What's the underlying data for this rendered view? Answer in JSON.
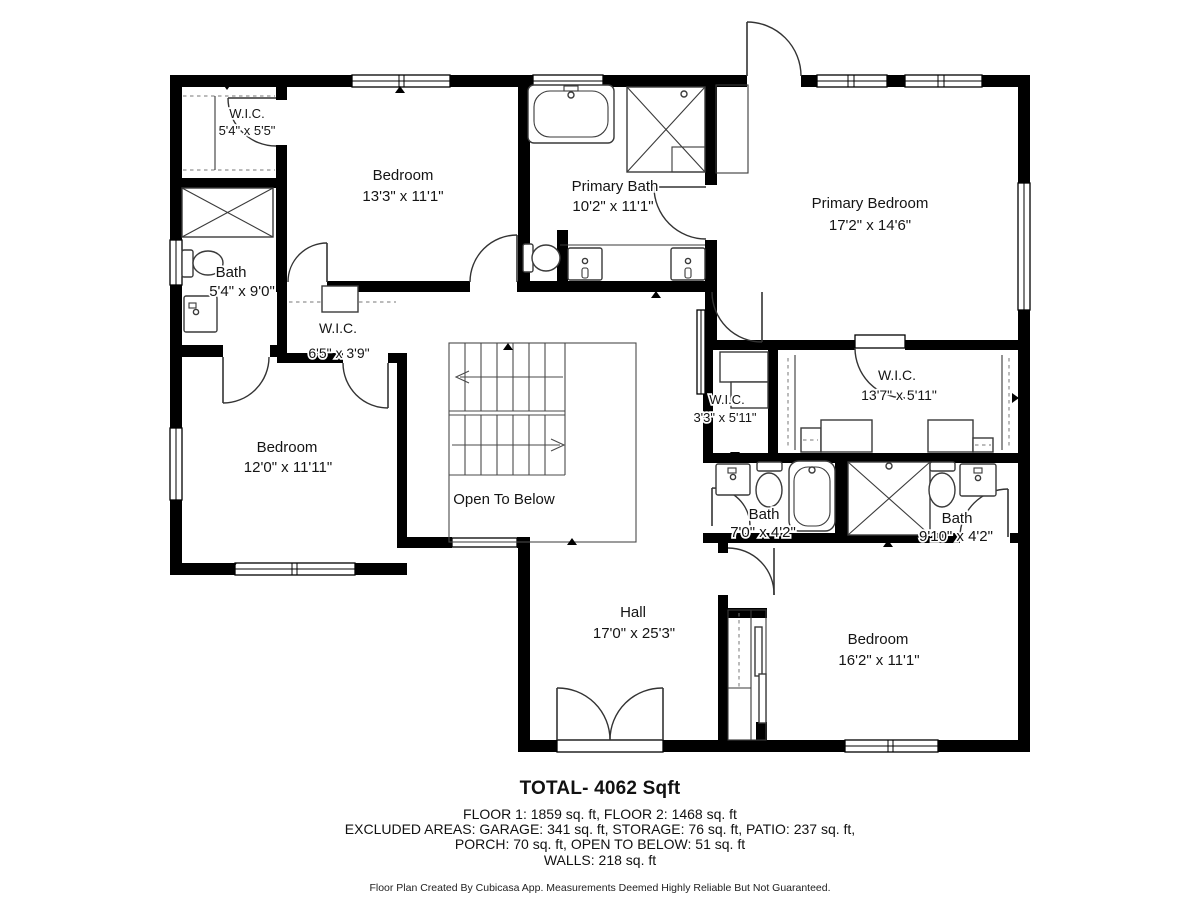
{
  "rooms": {
    "wic_top_left": {
      "name": "W.I.C.",
      "dims": "5'4\" x 5'5\""
    },
    "bedroom_top": {
      "name": "Bedroom",
      "dims": "13'3\" x 11'1\""
    },
    "primary_bath": {
      "name": "Primary Bath",
      "dims": "10'2\" x 11'1\""
    },
    "primary_bedroom": {
      "name": "Primary Bedroom",
      "dims": "17'2\" x 14'6\""
    },
    "bath_left": {
      "name": "Bath",
      "dims": "5'4\" x 9'0\""
    },
    "wic_shared": {
      "name": "W.I.C.",
      "dims": "6'5\" x 3'9\""
    },
    "bedroom_left": {
      "name": "Bedroom",
      "dims": "12'0\" x 11'11\""
    },
    "open_to_below": {
      "name": "Open To Below"
    },
    "wic_small": {
      "name": "W.I.C.",
      "dims": "3'3\" x 5'11\""
    },
    "wic_primary": {
      "name": "W.I.C.",
      "dims": "13'7\" x 5'11\""
    },
    "bath_middle": {
      "name": "Bath",
      "dims": "7'0\" x 4'2\""
    },
    "bath_right": {
      "name": "Bath",
      "dims": "9'10\" x 4'2\""
    },
    "hall": {
      "name": "Hall",
      "dims": "17'0\" x 25'3\""
    },
    "bedroom_bottom": {
      "name": "Bedroom",
      "dims": "16'2\" x 11'1\""
    }
  },
  "summary": {
    "total": "TOTAL- 4062 Sqft",
    "line1": "FLOOR 1: 1859 sq. ft, FLOOR 2: 1468 sq. ft",
    "line2": "EXCLUDED AREAS: GARAGE: 341 sq. ft, STORAGE: 76 sq. ft, PATIO: 237 sq. ft,",
    "line3": "PORCH: 70 sq. ft, OPEN TO BELOW: 51 sq. ft",
    "line4": "WALLS: 218 sq. ft"
  },
  "disclaimer": "Floor Plan Created By Cubicasa App. Measurements Deemed Highly Reliable But Not Guaranteed.",
  "colors": {
    "wall": "#000000",
    "fixture_stroke": "#3a3a3a",
    "text": "#141414"
  }
}
